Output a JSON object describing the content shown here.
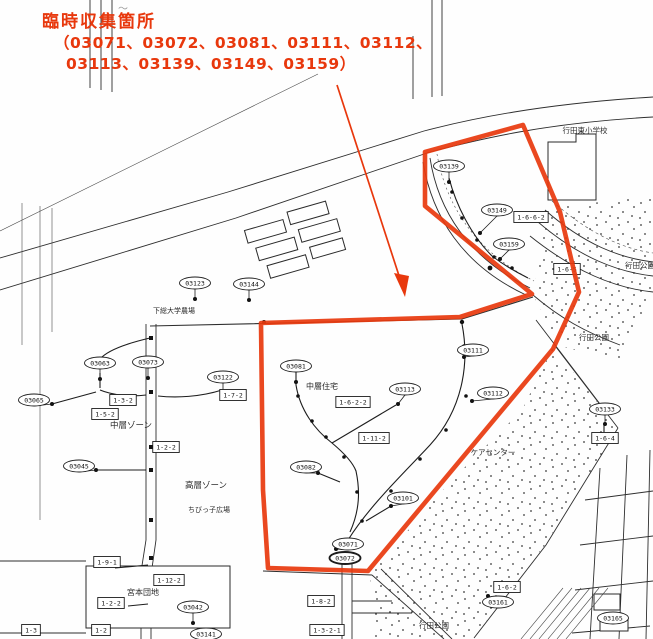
{
  "annotation": {
    "title": "臨時収集箇所",
    "codes_line1": "（03071、03072、03081、03111、03112、",
    "codes_line2": "03113、03139、03149、03159）",
    "red_color": "#e8380d"
  },
  "map": {
    "place_labels": [
      {
        "text": "行田東小学校",
        "x": 585,
        "y": 133,
        "size": 7.5
      },
      {
        "text": "下総大学農場",
        "x": 174,
        "y": 313,
        "size": 7
      },
      {
        "text": "中層ゾーン",
        "x": 131,
        "y": 428,
        "size": 8.5
      },
      {
        "text": "高層ゾーン",
        "x": 206,
        "y": 488,
        "size": 8.5
      },
      {
        "text": "中層住宅",
        "x": 322,
        "y": 389,
        "size": 8
      },
      {
        "text": "ケアセンター",
        "x": 493,
        "y": 455,
        "size": 7.5
      },
      {
        "text": "ちびっ子広場",
        "x": 209,
        "y": 512,
        "size": 7
      },
      {
        "text": "宮本団地",
        "x": 143,
        "y": 595,
        "size": 8
      },
      {
        "text": "行田公園",
        "x": 640,
        "y": 268,
        "size": 7.5
      },
      {
        "text": "行田公園",
        "x": 594,
        "y": 340,
        "size": 7.5
      },
      {
        "text": "行田公園",
        "x": 434,
        "y": 628,
        "size": 7.5
      }
    ],
    "collection_points": [
      {
        "code": "03139",
        "x": 449,
        "y": 166
      },
      {
        "code": "03149",
        "x": 497,
        "y": 210,
        "px": 480,
        "py": 233
      },
      {
        "code": "03159",
        "x": 509,
        "y": 244,
        "px": 500,
        "py": 259
      },
      {
        "code": "03111",
        "x": 473,
        "y": 350,
        "px": 464,
        "py": 357
      },
      {
        "code": "03112",
        "x": 493,
        "y": 393,
        "px": 472,
        "py": 401
      },
      {
        "code": "03113",
        "x": 405,
        "y": 389,
        "px": 398,
        "py": 404
      },
      {
        "code": "03081",
        "x": 296,
        "y": 366
      },
      {
        "code": "03071",
        "x": 348,
        "y": 544,
        "px": 336,
        "py": 549
      },
      {
        "code": "03072",
        "x": 345,
        "y": 558,
        "px": 334,
        "py": 560,
        "bold": true
      },
      {
        "code": "03144",
        "x": 249,
        "y": 284
      },
      {
        "code": "03123",
        "x": 195,
        "y": 283
      },
      {
        "code": "03073",
        "x": 148,
        "y": 362
      },
      {
        "code": "03063",
        "x": 100,
        "y": 363
      },
      {
        "code": "03065",
        "x": 34,
        "y": 400,
        "px": 52,
        "py": 404
      },
      {
        "code": "03122",
        "x": 223,
        "y": 377
      },
      {
        "code": "03133",
        "x": 605,
        "y": 409,
        "px": 605,
        "py": 424
      },
      {
        "code": "03045",
        "x": 79,
        "y": 466,
        "px": 96,
        "py": 470
      },
      {
        "code": "03082",
        "x": 306,
        "y": 467,
        "px": 318,
        "py": 473
      },
      {
        "code": "03101",
        "x": 403,
        "y": 498,
        "px": 391,
        "py": 506
      },
      {
        "code": "03161",
        "x": 498,
        "y": 602,
        "px": 488,
        "py": 596
      },
      {
        "code": "03165",
        "x": 613,
        "y": 618,
        "px": 600,
        "py": 618
      },
      {
        "code": "03042",
        "x": 193,
        "y": 607
      },
      {
        "code": "03141",
        "x": 206,
        "y": 634
      }
    ],
    "route_labels": [
      {
        "code": "1-6-6-2",
        "x": 531,
        "y": 217
      },
      {
        "code": "1-6-5",
        "x": 567,
        "y": 269
      },
      {
        "code": "1-6-2-2",
        "x": 353,
        "y": 402
      },
      {
        "code": "1-11-2",
        "x": 374,
        "y": 438
      },
      {
        "code": "1-6-4",
        "x": 605,
        "y": 438
      },
      {
        "code": "1-3-2",
        "x": 123,
        "y": 400
      },
      {
        "code": "1-5-2",
        "x": 105,
        "y": 414
      },
      {
        "code": "1-7-2",
        "x": 233,
        "y": 395
      },
      {
        "code": "1-2-2",
        "x": 166,
        "y": 447
      },
      {
        "code": "1-9-1",
        "x": 107,
        "y": 562
      },
      {
        "code": "1-12-2",
        "x": 169,
        "y": 580
      },
      {
        "code": "1-2-2",
        "x": 111,
        "y": 603
      },
      {
        "code": "1-2",
        "x": 101,
        "y": 630
      },
      {
        "code": "1-3",
        "x": 31,
        "y": 630
      },
      {
        "code": "1-8-2",
        "x": 321,
        "y": 601
      },
      {
        "code": "1-3-2-1",
        "x": 327,
        "y": 630
      },
      {
        "code": "1-6-2",
        "x": 507,
        "y": 587
      }
    ]
  }
}
